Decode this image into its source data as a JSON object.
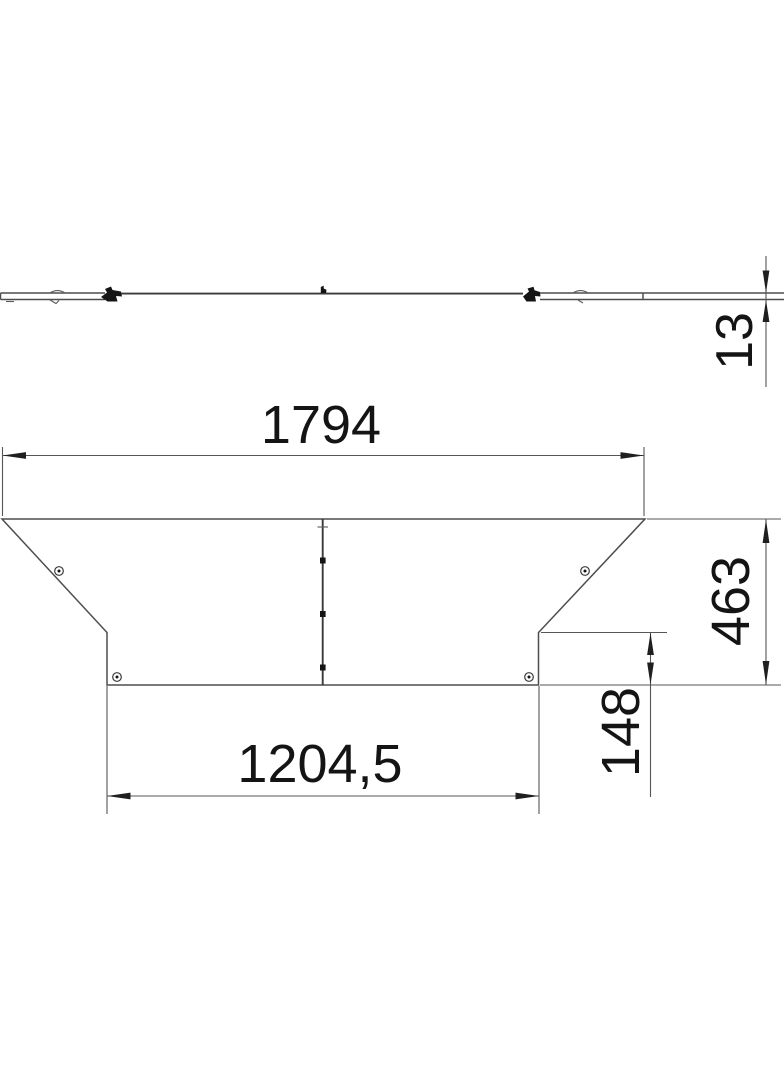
{
  "drawing": {
    "kind": "dimensioned-technical-drawing",
    "description": "Plan and side view of a flat tee cover plate with turnbuckle clips",
    "colors": {
      "background": "#ffffff",
      "part_line": "#4d4d4d",
      "dimension_line": "#565656",
      "text": "#141414"
    },
    "side_view": {
      "thickness": {
        "label": "13"
      }
    },
    "plan_view": {
      "overall_width": {
        "label": "1794"
      },
      "overall_depth": {
        "label": "463"
      },
      "branch_offset": {
        "label": "148"
      },
      "bottom_width": {
        "label": "1204,5"
      }
    }
  }
}
